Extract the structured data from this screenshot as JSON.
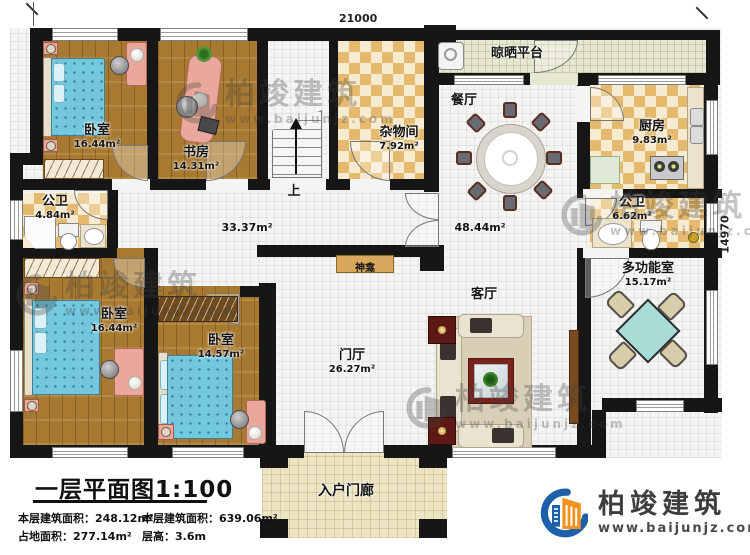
{
  "dimensions": {
    "width_label": "21000",
    "height_label": "14970"
  },
  "rooms": {
    "bedroom_tl": {
      "name": "卧室",
      "area": "16.44m²"
    },
    "study": {
      "name": "书房",
      "area": "14.31m²"
    },
    "storage": {
      "name": "杂物间",
      "area": "7.92m²"
    },
    "drying_platform": {
      "name": "晾晒平台"
    },
    "dining": {
      "name": "餐厅"
    },
    "kitchen": {
      "name": "厨房",
      "area": "9.83m²"
    },
    "bath_left": {
      "name": "公卫",
      "area": "4.84m²"
    },
    "bath_right": {
      "name": "公卫",
      "area": "6.62m²"
    },
    "multi_function": {
      "name": "多功能室",
      "area": "15.17m²"
    },
    "living": {
      "name": "客厅"
    },
    "foyer": {
      "name": "门厅",
      "area": "26.27m²"
    },
    "bedroom_bl": {
      "name": "卧室",
      "area": "16.44m²"
    },
    "bedroom_bm": {
      "name": "卧室",
      "area": "14.57m²"
    },
    "porch": {
      "name": "入户门廊"
    },
    "shrine": {
      "name": "神龛"
    },
    "hallway_area": "33.37m²",
    "open_area": "48.44m²",
    "stairs_label": "上"
  },
  "title_block": {
    "title": "一层平面图1:100",
    "stats": [
      {
        "label": "本层建筑面积：",
        "value": "248.12m²"
      },
      {
        "label": "本层建筑面积：",
        "value": "639.06m²"
      },
      {
        "label": "占地面积：",
        "value": "277.14m²"
      },
      {
        "label": "层高：",
        "value": "3.6m"
      }
    ]
  },
  "branding": {
    "brand": "柏竣建筑",
    "url": "www.baijunjz.com"
  },
  "colors": {
    "wall": "#161616",
    "wood": "#a87a31",
    "checker": "#e5ba6e",
    "tile": "#f4f4f2",
    "platform": "#e6e7d0",
    "porch": "#ece4c2",
    "bed": "#74c8de",
    "logo_blue": "#1d5fa8",
    "logo_orange": "#f29220"
  }
}
